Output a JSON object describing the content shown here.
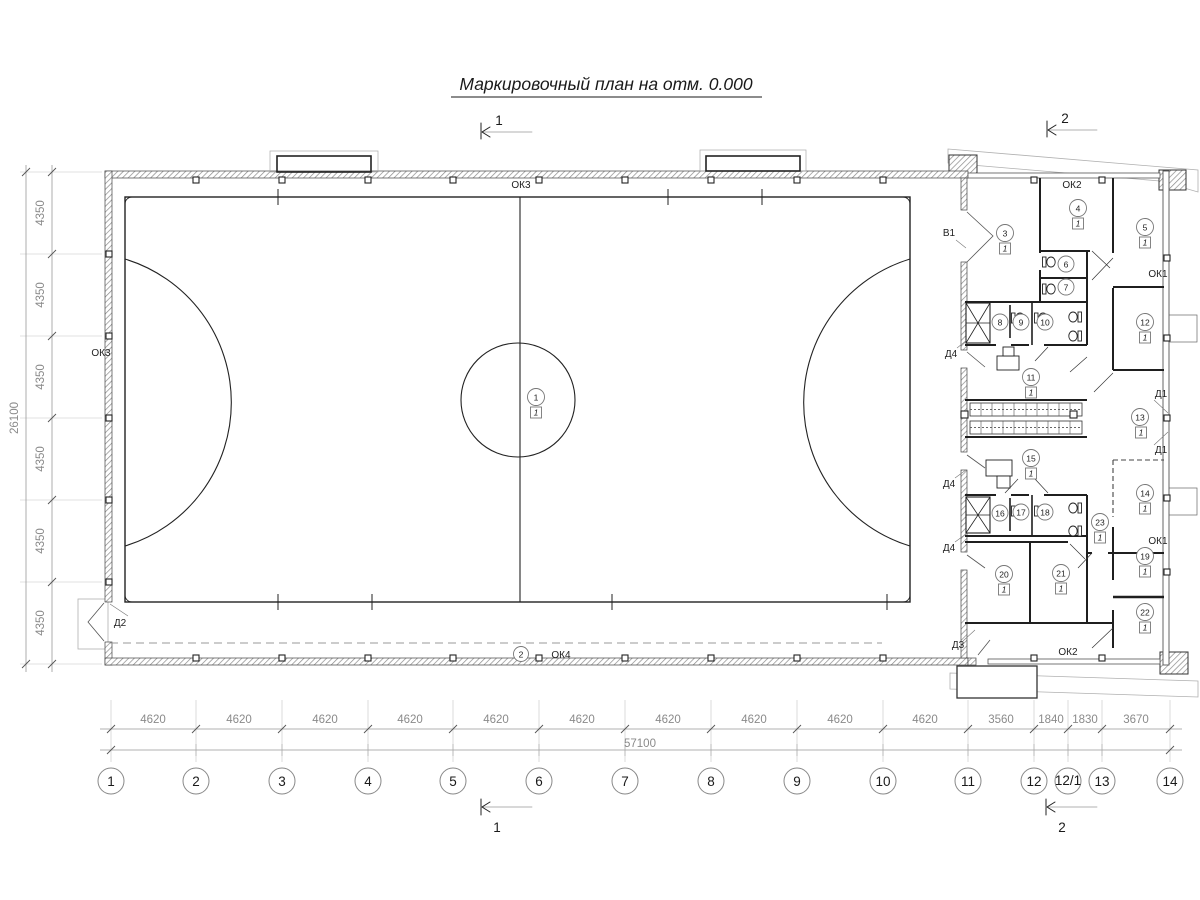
{
  "title": "Маркировочный план на отм. 0.000",
  "floor_mark": "1",
  "room_numbers": [
    "1",
    "2",
    "3",
    "4",
    "5",
    "6",
    "7",
    "8",
    "9",
    "10",
    "11",
    "12",
    "13",
    "14",
    "15",
    "16",
    "17",
    "18",
    "19",
    "20",
    "21",
    "22",
    "23"
  ],
  "wall_labels": {
    "ok1": "ОК1",
    "ok2": "ОК2",
    "ok3": "ОК3",
    "ok4": "ОК4",
    "d1": "Д1",
    "d2": "Д2",
    "d3": "Д3",
    "d4": "Д4",
    "v1": "В1"
  },
  "section_marks": {
    "one": "1",
    "two": "2"
  },
  "dims_bottom": {
    "segments": [
      "4620",
      "4620",
      "4620",
      "4620",
      "4620",
      "4620",
      "4620",
      "4620",
      "4620",
      "4620",
      "3560",
      "1840",
      "1830",
      "3670"
    ],
    "total": "57100"
  },
  "dims_left": {
    "segments": [
      "4350",
      "4350",
      "4350",
      "4350",
      "4350",
      "4350"
    ],
    "total": "26100"
  },
  "grid_axes": [
    "1",
    "2",
    "3",
    "4",
    "5",
    "6",
    "7",
    "8",
    "9",
    "10",
    "11",
    "12",
    "12/1",
    "13",
    "14"
  ],
  "colors": {
    "line": "#1f1f1f",
    "dim": "#8a8a8a",
    "light": "#c4c4c4"
  }
}
